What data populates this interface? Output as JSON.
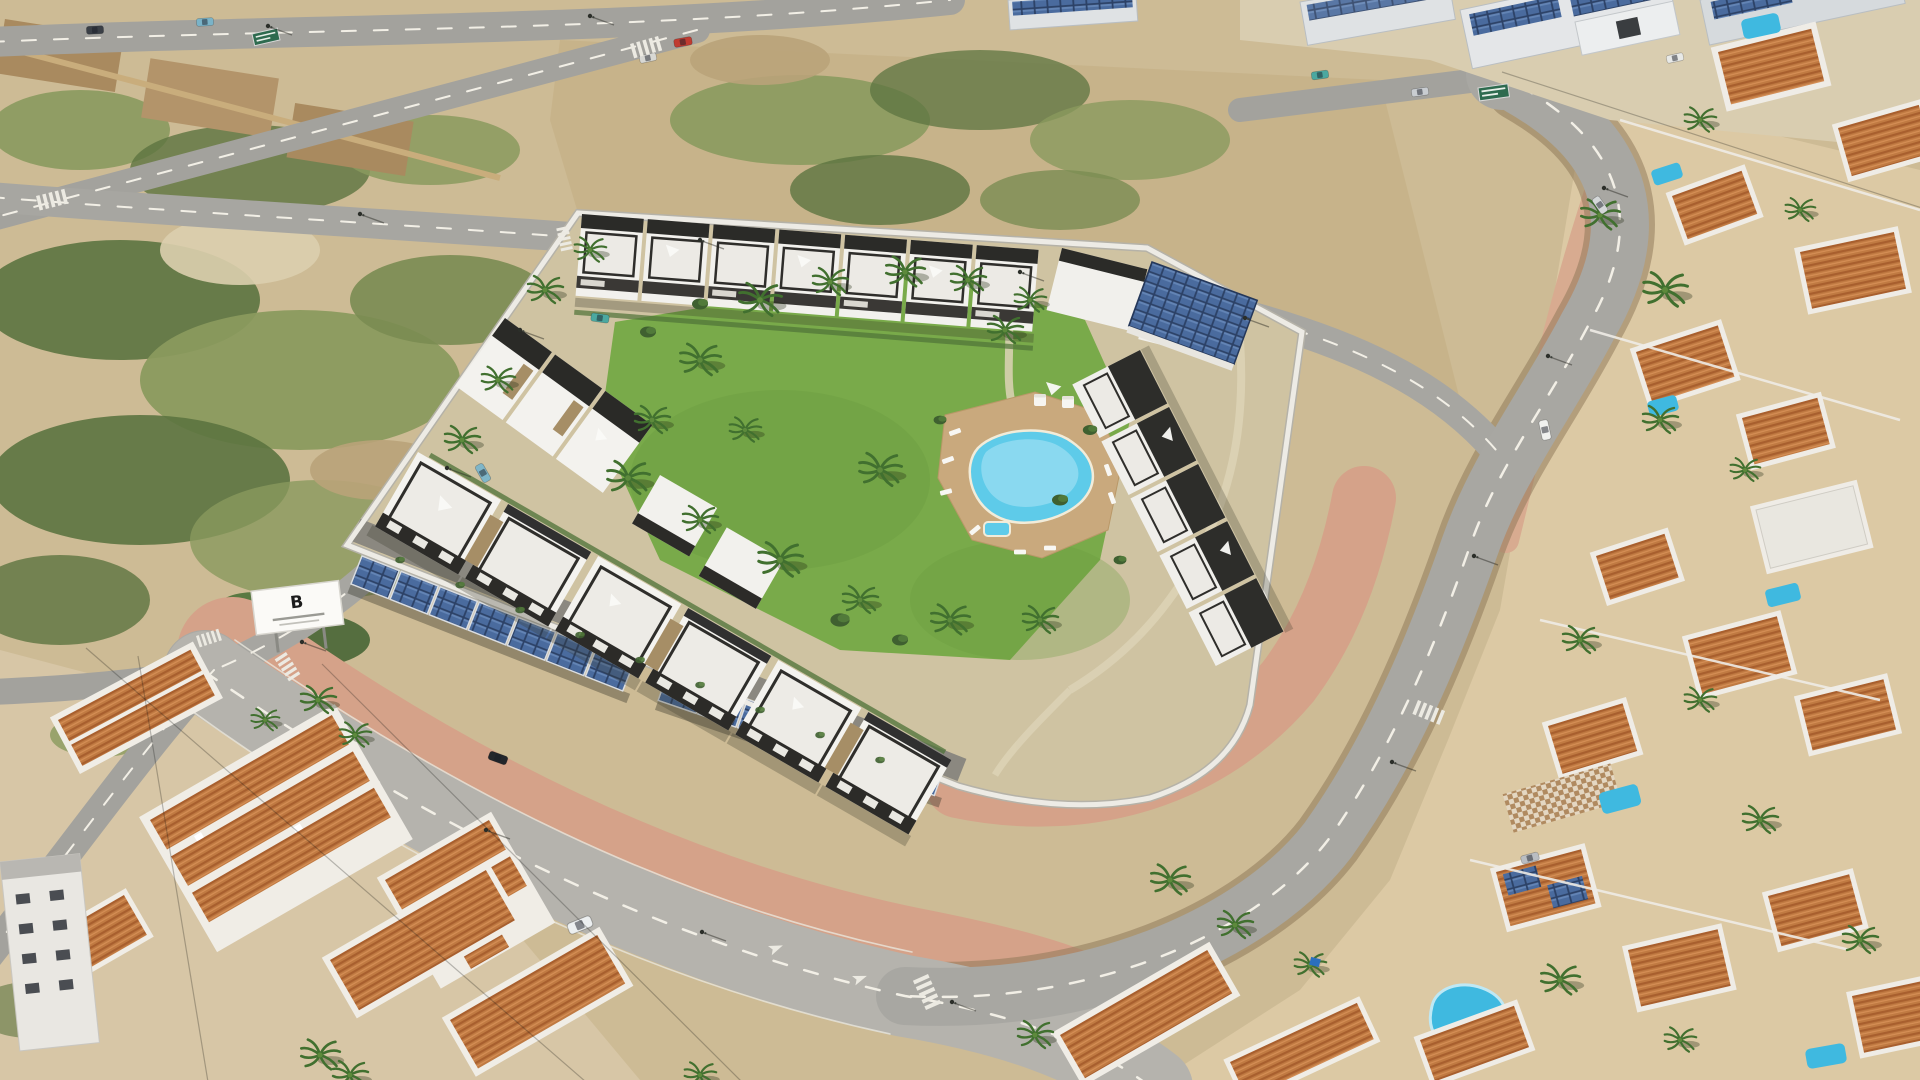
{
  "meta": {
    "type": "aerial-render-photograph",
    "title": "Aerial visualisation of a new-build residential complex"
  },
  "scene": {
    "description": "Sunny aerial 3D render of a gated new-build residential complex: white modern townhouses with charcoal parapet roof terraces arranged around a communal landscaped courtyard with palm trees and a free-form swimming pool. Photovoltaic carport canopies line the inner perimeter wall. The site is bordered by new roads and empty scrubland plots to the north-west, an industrial estate with rooftop solar to the north-east, and an established Spanish suburb of terracotta-roofed villas with private pools to the south and east.",
    "setting": "coastal suburb, midday sun",
    "features": [
      "white townhouses with black parapet roof terraces and white sun sails",
      "communal lagoon-style swimming pool with sun loungers and day beds",
      "landscaped courtyard lawn with palm trees",
      "two rows of photovoltaic carport canopies along the perimeter wall",
      "white perimeter wall around the complex",
      "developer billboard with a letter-B logo",
      "empty scrubland building plots crossed by new roads",
      "road junctions with zebra crossings and lane arrows",
      "industrial warehouses with rooftop solar panels",
      "terracotta-roofed villas and townhouses with private pools",
      "kidney-shaped private pool",
      "palm-lined streets and street lamps"
    ],
    "counts": {
      "solar_carport_strips": 2,
      "courtyard_pools": 1,
      "private_pools_visible": 8,
      "billboards": 1
    }
  },
  "billboard": {
    "logo_letter": "B"
  },
  "palette": {
    "sand": "#cdbb95",
    "sandLight": "#dccfae",
    "sandDark": "#b9a379",
    "scrub": "#8a9a5e",
    "scrubDark": "#5c7440",
    "bush": "#3f6030",
    "road": "#a7a6a1",
    "roadLight": "#b5b3ad",
    "roadDark": "#98968f",
    "marking": "#f2efe6",
    "sidewalkPink": "#d5a289",
    "lawn": "#79aa4a",
    "lawnDark": "#5f8f3a",
    "deck": "#c9a97d",
    "pool": "#5ecbe9",
    "poolLight": "#aee6f6",
    "building": "#f3f2ee",
    "charcoal": "#2c2b28",
    "stone": "#a68e66",
    "wall": "#edebe5",
    "solar": "#4a6b9e",
    "solarDark": "#2c4166",
    "terracotta": "#c07a42",
    "warehouseRoof": "#dfe2e4",
    "villaPool": "#3fb9e0",
    "signGreen": "#2e6b4f"
  }
}
